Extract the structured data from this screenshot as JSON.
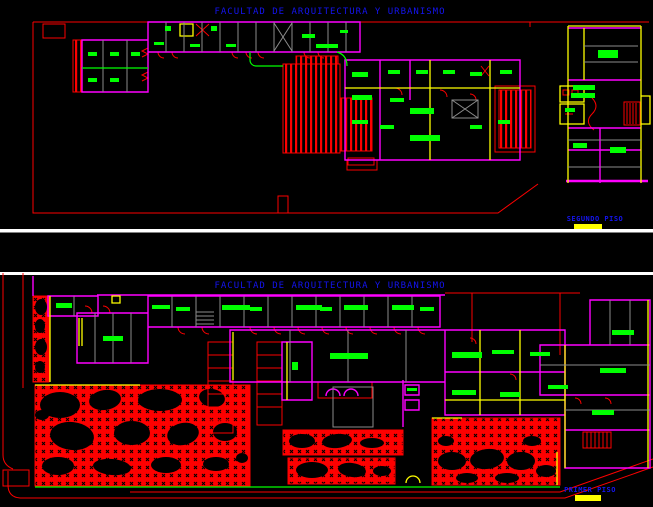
{
  "window": {
    "width": 653,
    "height": 507,
    "description": "CAD drawing sheet with two architectural floor plans"
  },
  "colors": {
    "bg": "#000000",
    "blue": "#1414F0",
    "red": "#FD0000",
    "magenta": "#FF00FF",
    "green": "#00FF00",
    "yellow": "#FFFF00",
    "gray": "#8C8C8C",
    "white": "#FFFFFF"
  },
  "viewports": [
    {
      "id": "segundo-piso",
      "title": "FACULTAD DE ARQUITECTURA Y URBANISMO",
      "legend": {
        "label": "SEGUNDO PISO",
        "swatch_color": "#FFFF00"
      }
    },
    {
      "id": "primer-piso",
      "title": "FACULTAD DE ARQUITECTURA Y URBANISMO",
      "legend": {
        "label": "PRIMER PISO",
        "swatch_color": "#FFFF00"
      }
    }
  ]
}
